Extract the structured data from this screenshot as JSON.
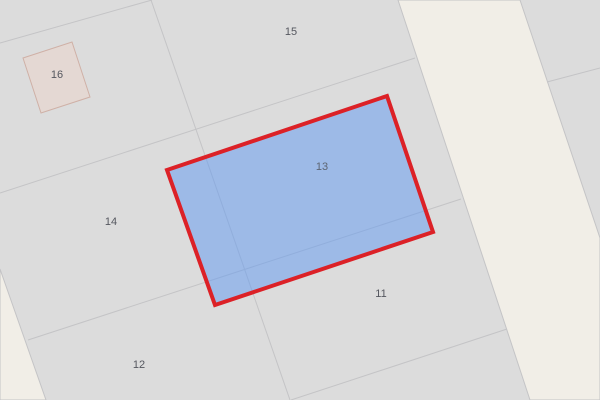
{
  "map": {
    "canvas": {
      "width": 600,
      "height": 400,
      "background_color": "#dcdcdc"
    },
    "colors": {
      "parcel_gray": "#dcdcdc",
      "road_beige": "#f1eee7",
      "boundary_line": "#c4c4c6",
      "label_text": "#55575f",
      "selection_fill": "rgba(94,152,242,0.5)",
      "selection_stroke": "#dc2127",
      "building_fill": "#e4d8d3",
      "building_stroke": "#cfb0a6"
    },
    "roads": [
      {
        "name": "road-main-diagonal",
        "points": [
          [
            398,
            0
          ],
          [
            520,
            0
          ],
          [
            600,
            238
          ],
          [
            600,
            400
          ],
          [
            530,
            400
          ]
        ],
        "fill": "#f1eee7",
        "stroke": "#c4c4c6",
        "stroke_width": 1,
        "interactable": "true"
      },
      {
        "name": "road-bottom-left-corner",
        "points": [
          [
            0,
            269
          ],
          [
            46,
            400
          ],
          [
            0,
            400
          ]
        ],
        "fill": "#f1eee7",
        "stroke": "#c4c4c6",
        "stroke_width": 1,
        "interactable": "true"
      }
    ],
    "boundaries": [
      {
        "name": "boundary-top-left",
        "from": [
          0,
          43
        ],
        "to": [
          152,
          0
        ],
        "interactable": "false"
      },
      {
        "name": "boundary-15-14",
        "from": [
          0,
          193
        ],
        "to": [
          415,
          58
        ],
        "interactable": "false"
      },
      {
        "name": "boundary-14-12",
        "from": [
          28,
          340
        ],
        "to": [
          461,
          199
        ],
        "interactable": "false"
      },
      {
        "name": "boundary-11-south",
        "from": [
          291,
          400
        ],
        "to": [
          507,
          329
        ],
        "interactable": "false"
      },
      {
        "name": "boundary-vertical-14-13",
        "from": [
          151,
          0
        ],
        "to": [
          290,
          400
        ],
        "interactable": "false"
      },
      {
        "name": "boundary-east-of-road",
        "from": [
          547,
          82
        ],
        "to": [
          600,
          68
        ],
        "interactable": "false"
      }
    ],
    "buildings": [
      {
        "name": "building-16",
        "points": [
          [
            23,
            58
          ],
          [
            72,
            42
          ],
          [
            90,
            97
          ],
          [
            41,
            113
          ]
        ],
        "fill": "#e4d8d3",
        "stroke": "#cfb0a6",
        "stroke_width": 1,
        "interactable": "true"
      }
    ],
    "selection": {
      "name": "selected-parcel-13",
      "points": [
        [
          167,
          170
        ],
        [
          387,
          96
        ],
        [
          433,
          232
        ],
        [
          215,
          305
        ]
      ],
      "fill": "rgba(94,152,242,0.5)",
      "stroke": "#dc2127",
      "stroke_width": 4,
      "interactable": "true"
    },
    "labels": [
      {
        "name": "parcel-label-16",
        "text": "16",
        "x": 57,
        "y": 75,
        "color": "#55575f",
        "interactable": "false"
      },
      {
        "name": "parcel-label-15",
        "text": "15",
        "x": 291,
        "y": 32,
        "color": "#55575f",
        "interactable": "false"
      },
      {
        "name": "parcel-label-14",
        "text": "14",
        "x": 111,
        "y": 222,
        "color": "#55575f",
        "interactable": "false"
      },
      {
        "name": "parcel-label-13",
        "text": "13",
        "x": 322,
        "y": 167,
        "color": "#5d6572",
        "interactable": "false"
      },
      {
        "name": "parcel-label-12",
        "text": "12",
        "x": 139,
        "y": 365,
        "color": "#55575f",
        "interactable": "false"
      },
      {
        "name": "parcel-label-11",
        "text": "11",
        "x": 381,
        "y": 294,
        "color": "#55575f",
        "interactable": "false"
      }
    ]
  }
}
